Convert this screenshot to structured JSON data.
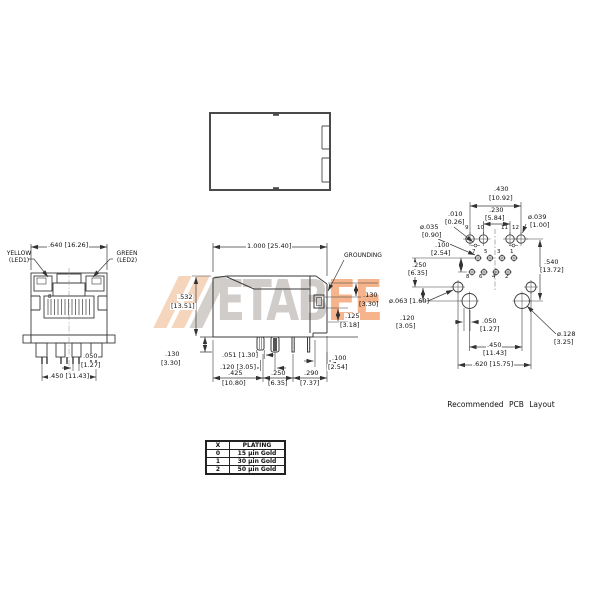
{
  "watermark": {
    "gray_text": "ETAB",
    "orange_text": "EE"
  },
  "front_view": {
    "dim_width": ".640 [16.26]",
    "led1_line1": "YELLOW",
    "led1_line2": "(LED1)",
    "led2_line1": "GREEN",
    "led2_line2": "(LED2)",
    "pin_label": "8",
    "dim_pitch_in": ".050",
    "dim_pitch_mm": "[1.27]",
    "dim_span": ".450 [11.43]"
  },
  "side_view": {
    "dim_length": "1.000 [25.40]",
    "dim_height_in": ".532",
    "dim_height_mm": "[13.51]",
    "grounding_label": "GROUNDING",
    "dim_tab_in": ".130",
    "dim_tab_mm": "[3.30]",
    "dim_tail_in": ".125",
    "dim_tail_mm": "[3.18]",
    "dim_standoff_in": ".130",
    "dim_standoff_mm": "[3.30]",
    "dim_peg_width": ".051 [1.30]",
    "dim_peg_pitch": ".120 [3.05]",
    "dim_c_in": ".425",
    "dim_c_mm": "[10.80]",
    "dim_d_in": ".250",
    "dim_d_mm": "[6.35]",
    "dim_e_in": ".290",
    "dim_e_mm": "[7.37]",
    "dim_f_in": ".100",
    "dim_f_mm": "[2.54]"
  },
  "pcb_layout": {
    "caption": "Recommended PCB Layout",
    "dim_430_in": ".430",
    "dim_430_mm": "[10.92]",
    "dim_230_in": ".230",
    "dim_230_mm": "[5.84]",
    "dim_010_in": ".010",
    "dim_010_mm": "[0.26]",
    "dia_035_in": "ø.035",
    "dia_035_mm": "[0.90]",
    "dia_039_in": "ø.039",
    "dia_039_mm": "[1.00]",
    "dim_100_in": ".100",
    "dim_100_mm": "[2.54]",
    "dim_540_in": ".540",
    "dim_540_mm": "[13.72]",
    "dim_250_in": ".250",
    "dim_250_mm": "[6.35]",
    "dia_063": "ø.063 [1.60]",
    "dim_120_in": ".120",
    "dim_120_mm": "[3.05]",
    "dim_050_in": ".050",
    "dim_050_mm": "[1.27]",
    "dim_450_in": ".450",
    "dim_450_mm": "[11.43]",
    "dim_620": ".620 [15.75]",
    "dia_128_in": "ø.128",
    "dia_128_mm": "[3.25]",
    "pins_top": [
      "9",
      "10",
      "11",
      "12"
    ],
    "pins_upper": [
      "7",
      "5",
      "3",
      "1"
    ],
    "pins_lower": [
      "8",
      "6",
      "4",
      "2"
    ]
  },
  "plating_table": {
    "col1": "X",
    "col2": "PLATING",
    "rows": [
      [
        "0",
        "15 μin Gold"
      ],
      [
        "1",
        "30 μin Gold"
      ],
      [
        "2",
        "50 μin Gold"
      ]
    ]
  }
}
